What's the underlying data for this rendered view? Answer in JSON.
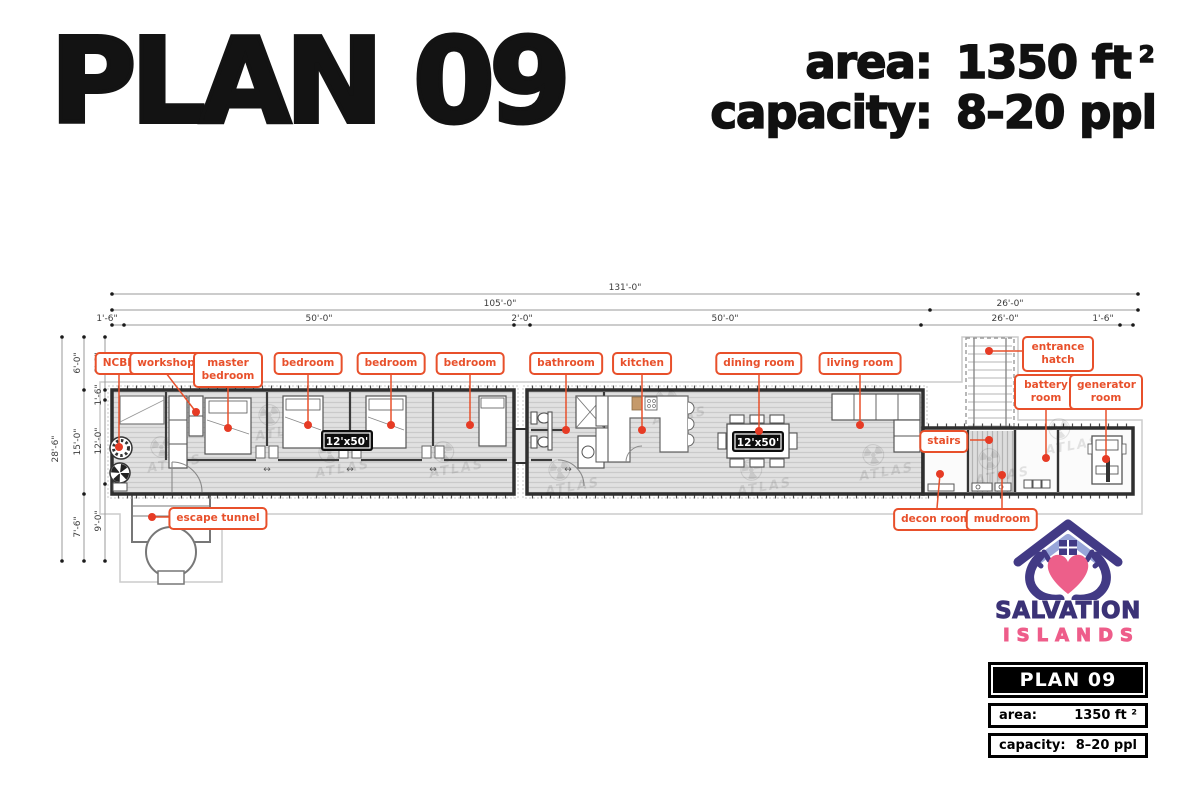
{
  "header": {
    "title": "PLAN 09",
    "area_label": "area:",
    "area_value": "1350 ft",
    "area_sup": "2",
    "capacity_label": "capacity:",
    "capacity_value": "8-20 ppl"
  },
  "plan": {
    "watermark_icon": "☢",
    "watermark_text": "ATLAS",
    "door_arrow": "↔",
    "badges": [
      "12'x50'",
      "12'x50'"
    ],
    "rooms": [
      {
        "id": "ncbr",
        "label": "NCBR"
      },
      {
        "id": "workshop",
        "label": "workshop"
      },
      {
        "id": "master-bedroom",
        "label": "master bedroom"
      },
      {
        "id": "bedroom-1",
        "label": "bedroom"
      },
      {
        "id": "bedroom-2",
        "label": "bedroom"
      },
      {
        "id": "bedroom-3",
        "label": "bedroom"
      },
      {
        "id": "bathroom",
        "label": "bathroom"
      },
      {
        "id": "kitchen",
        "label": "kitchen"
      },
      {
        "id": "dining-room",
        "label": "dining room"
      },
      {
        "id": "living-room",
        "label": "living room"
      },
      {
        "id": "entrance-hatch",
        "label": "entrance hatch"
      },
      {
        "id": "battery-room",
        "label": "battery room"
      },
      {
        "id": "generator-room",
        "label": "generator room"
      },
      {
        "id": "stairs",
        "label": "stairs"
      },
      {
        "id": "decon-room",
        "label": "decon room"
      },
      {
        "id": "mudroom",
        "label": "mudroom"
      },
      {
        "id": "escape-tunnel",
        "label": "escape tunnel"
      }
    ],
    "dims": {
      "top": {
        "total": "131'-0\"",
        "row2": [
          "105'-0\"",
          "26'-0\""
        ],
        "row3": [
          "1'-6\"",
          "50'-0\"",
          "2'-0\"",
          "50'-0\"",
          "26'-0\"",
          "1'-6\""
        ]
      },
      "left": {
        "total": "28'-6\"",
        "col2": [
          "6'-0\"",
          "15'-0\"",
          "7'-6\""
        ],
        "col3": [
          "6'-0\"",
          "1'-6\"",
          "12'-0\"",
          "9'-0\""
        ]
      }
    }
  },
  "branding": {
    "logo_line1": "SALVATION",
    "logo_line2": "ISLANDS",
    "box_title": "PLAN 09",
    "area_label": "area:",
    "area_value": "1350 ft ²",
    "capacity_label": "capacity:",
    "capacity_value": "8–20 ppl"
  },
  "colors": {
    "accent_orange": "#e8502b",
    "dot_red": "#e63b25",
    "logo_purple": "#3b3276",
    "logo_pink": "#ee5d8a",
    "ink": "#131313"
  }
}
